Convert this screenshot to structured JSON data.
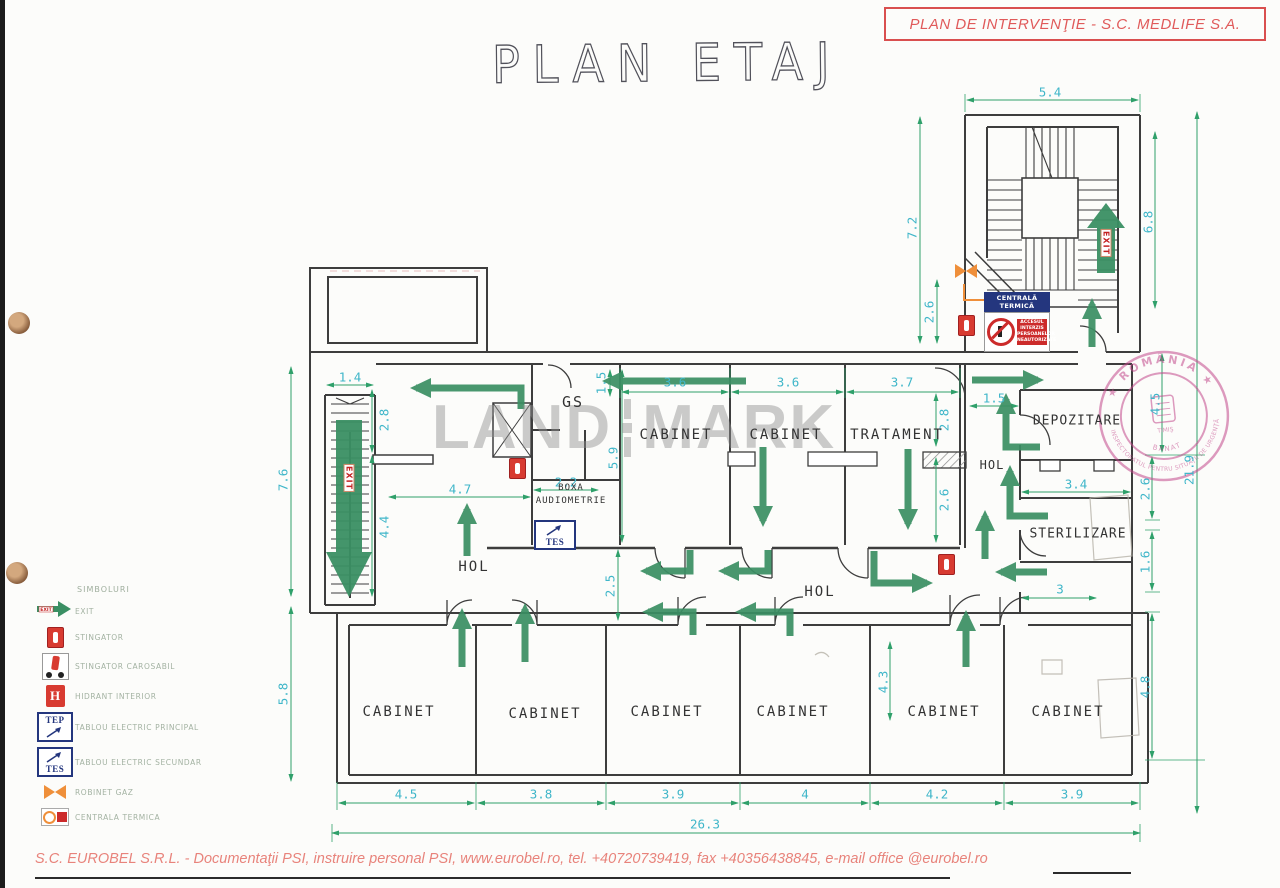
{
  "header": {
    "plan_box_label": "PLAN DE INTERVENŢIE - S.C. MEDLIFE S.A.",
    "title": "PLAN ETAJ"
  },
  "watermark": {
    "part1": "LAND",
    "part2": "MARK"
  },
  "footer": {
    "text": "S.C. EUROBEL S.R.L. - Documentaţii PSI, instruire personal PSI, www.eurobel.ro, tel. +40720739419, fax +40356438845, e-mail office @eurobel.ro"
  },
  "exit_label": "EXIT",
  "signs": {
    "boiler_header": "CENTRALĂ TERMICĂ",
    "access_lines": [
      "ACCESUL",
      "INTERZIS",
      "PERSOANELOR",
      "NEAUTORIZATE"
    ]
  },
  "stamp": {
    "top": "★ ROMÂNIA ★",
    "bottom": "INSPECTORATUL PENTRU SITUAŢII DE URGENŢĂ",
    "inner": "BANAT",
    "center": "TIMIŞ"
  },
  "legend": {
    "title": "SIMBOLURI",
    "items": [
      {
        "icon": "exit",
        "label": "EXIT"
      },
      {
        "icon": "ext",
        "label": "STINGATOR"
      },
      {
        "icon": "mob",
        "label": "STINGATOR CAROSABIL"
      },
      {
        "icon": "hyd",
        "label": "HIDRANT INTERIOR"
      },
      {
        "icon": "tep",
        "label": "TABLOU ELECTRIC PRINCIPAL",
        "tag": "TEP"
      },
      {
        "icon": "tes",
        "label": "TABLOU ELECTRIC SECUNDAR",
        "tag": "TES"
      },
      {
        "icon": "valve",
        "label": "ROBINET GAZ"
      },
      {
        "icon": "boiler",
        "label": "CENTRALA TERMICA"
      }
    ]
  },
  "rooms": [
    {
      "t": "GS",
      "x": 573,
      "y": 402,
      "s": 15,
      "ls": 2
    },
    {
      "t": "CABINET",
      "x": 676,
      "y": 435,
      "s": 14,
      "ls": 2
    },
    {
      "t": "CABINET",
      "x": 786,
      "y": 435,
      "s": 14,
      "ls": 2
    },
    {
      "t": "TRATAMENT",
      "x": 897,
      "y": 435,
      "s": 14,
      "ls": 2
    },
    {
      "t": "BOXA",
      "x": 571,
      "y": 488,
      "s": 9,
      "ls": 1
    },
    {
      "t": "AUDIOMETRIE",
      "x": 571,
      "y": 501,
      "s": 9,
      "ls": 1
    },
    {
      "t": "HOL",
      "x": 474,
      "y": 567,
      "s": 14,
      "ls": 2
    },
    {
      "t": "HOL",
      "x": 820,
      "y": 592,
      "s": 14,
      "ls": 2
    },
    {
      "t": "HOL",
      "x": 992,
      "y": 465,
      "s": 12,
      "ls": 1
    },
    {
      "t": "DEPOZITARE",
      "x": 1077,
      "y": 421,
      "s": 13,
      "ls": 1
    },
    {
      "t": "STERILIZARE",
      "x": 1078,
      "y": 534,
      "s": 13,
      "ls": 1
    },
    {
      "t": "CABINET",
      "x": 399,
      "y": 712,
      "s": 14,
      "ls": 2
    },
    {
      "t": "CABINET",
      "x": 545,
      "y": 714,
      "s": 14,
      "ls": 2
    },
    {
      "t": "CABINET",
      "x": 667,
      "y": 712,
      "s": 14,
      "ls": 2
    },
    {
      "t": "CABINET",
      "x": 793,
      "y": 712,
      "s": 14,
      "ls": 2
    },
    {
      "t": "CABINET",
      "x": 944,
      "y": 712,
      "s": 14,
      "ls": 2
    },
    {
      "t": "CABINET",
      "x": 1068,
      "y": 712,
      "s": 14,
      "ls": 2
    }
  ],
  "dimensions": [
    {
      "t": "5.4",
      "x": 1050,
      "y": 92
    },
    {
      "t": "7.2",
      "x": 912,
      "y": 228,
      "r": -90
    },
    {
      "t": "6.8",
      "x": 1148,
      "y": 222,
      "r": -90
    },
    {
      "t": "2.6",
      "x": 929,
      "y": 312,
      "r": -90
    },
    {
      "t": "1.4",
      "x": 350,
      "y": 377
    },
    {
      "t": "2.8",
      "x": 384,
      "y": 420,
      "r": -90
    },
    {
      "t": "4.4",
      "x": 384,
      "y": 527,
      "r": -90
    },
    {
      "t": "7.6",
      "x": 283,
      "y": 480,
      "r": -90
    },
    {
      "t": "5.8",
      "x": 283,
      "y": 694,
      "r": -90
    },
    {
      "t": "1.5",
      "x": 601,
      "y": 383,
      "r": -90
    },
    {
      "t": "3.6",
      "x": 675,
      "y": 382
    },
    {
      "t": "3.6",
      "x": 788,
      "y": 382
    },
    {
      "t": "3.7",
      "x": 902,
      "y": 382
    },
    {
      "t": "5.9",
      "x": 613,
      "y": 458,
      "r": -90
    },
    {
      "t": "2.8",
      "x": 944,
      "y": 420,
      "r": -90
    },
    {
      "t": "2.6",
      "x": 944,
      "y": 500,
      "r": -90
    },
    {
      "t": "2.2",
      "x": 566,
      "y": 482
    },
    {
      "t": "4.7",
      "x": 460,
      "y": 489
    },
    {
      "t": "2.5",
      "x": 610,
      "y": 586,
      "r": -90
    },
    {
      "t": "1.5",
      "x": 994,
      "y": 398
    },
    {
      "t": "3.4",
      "x": 1076,
      "y": 484
    },
    {
      "t": "4.5",
      "x": 1155,
      "y": 404,
      "r": -90
    },
    {
      "t": "2.6",
      "x": 1145,
      "y": 489,
      "r": -90
    },
    {
      "t": "1.6",
      "x": 1145,
      "y": 562,
      "r": -90
    },
    {
      "t": "3",
      "x": 1060,
      "y": 589
    },
    {
      "t": "4.8",
      "x": 1145,
      "y": 687,
      "r": -90
    },
    {
      "t": "4.3",
      "x": 883,
      "y": 682,
      "r": -90
    },
    {
      "t": "21.9",
      "x": 1189,
      "y": 470,
      "r": -90
    },
    {
      "t": "4.5",
      "x": 406,
      "y": 794
    },
    {
      "t": "3.8",
      "x": 541,
      "y": 794
    },
    {
      "t": "3.9",
      "x": 673,
      "y": 794
    },
    {
      "t": "4",
      "x": 805,
      "y": 794
    },
    {
      "t": "4.2",
      "x": 937,
      "y": 794
    },
    {
      "t": "3.9",
      "x": 1072,
      "y": 794
    },
    {
      "t": "26.3",
      "x": 705,
      "y": 824
    }
  ],
  "arrows": [
    {
      "p": [
        [
          521,
          409
        ],
        [
          521,
          388
        ],
        [
          416,
          388
        ]
      ]
    },
    {
      "p": [
        [
          746,
          381
        ],
        [
          608,
          381
        ]
      ]
    },
    {
      "p": [
        [
          763,
          447
        ],
        [
          763,
          521
        ]
      ]
    },
    {
      "p": [
        [
          908,
          449
        ],
        [
          908,
          524
        ]
      ]
    },
    {
      "p": [
        [
          467,
          556
        ],
        [
          467,
          509
        ]
      ]
    },
    {
      "p": [
        [
          1092,
          347
        ],
        [
          1092,
          304
        ]
      ]
    },
    {
      "p": [
        [
          972,
          380
        ],
        [
          1038,
          380
        ]
      ]
    },
    {
      "p": [
        [
          1040,
          447
        ],
        [
          1006,
          447
        ],
        [
          1006,
          399
        ]
      ]
    },
    {
      "p": [
        [
          1048,
          516
        ],
        [
          1010,
          516
        ],
        [
          1010,
          471
        ]
      ]
    },
    {
      "p": [
        [
          985,
          559
        ],
        [
          985,
          516
        ]
      ]
    },
    {
      "p": [
        [
          1047,
          572
        ],
        [
          1001,
          572
        ]
      ]
    },
    {
      "p": [
        [
          690,
          550
        ],
        [
          690,
          571
        ],
        [
          646,
          571
        ]
      ]
    },
    {
      "p": [
        [
          768,
          550
        ],
        [
          768,
          571
        ],
        [
          724,
          571
        ]
      ]
    },
    {
      "p": [
        [
          874,
          551
        ],
        [
          874,
          583
        ],
        [
          927,
          583
        ]
      ]
    },
    {
      "p": [
        [
          693,
          635
        ],
        [
          693,
          612
        ],
        [
          648,
          612
        ]
      ]
    },
    {
      "p": [
        [
          790,
          636
        ],
        [
          790,
          612
        ],
        [
          741,
          612
        ]
      ]
    },
    {
      "p": [
        [
          462,
          667
        ],
        [
          462,
          614
        ]
      ]
    },
    {
      "p": [
        [
          525,
          662
        ],
        [
          525,
          609
        ]
      ]
    },
    {
      "p": [
        [
          966,
          667
        ],
        [
          966,
          616
        ]
      ]
    }
  ],
  "icons": [
    {
      "type": "ext",
      "x": 509,
      "y": 458
    },
    {
      "type": "ext",
      "x": 938,
      "y": 554
    },
    {
      "type": "ext",
      "x": 958,
      "y": 315
    },
    {
      "type": "tes",
      "x": 534,
      "y": 520,
      "tag": "TES"
    },
    {
      "type": "valve",
      "x": 955,
      "y": 264
    }
  ]
}
